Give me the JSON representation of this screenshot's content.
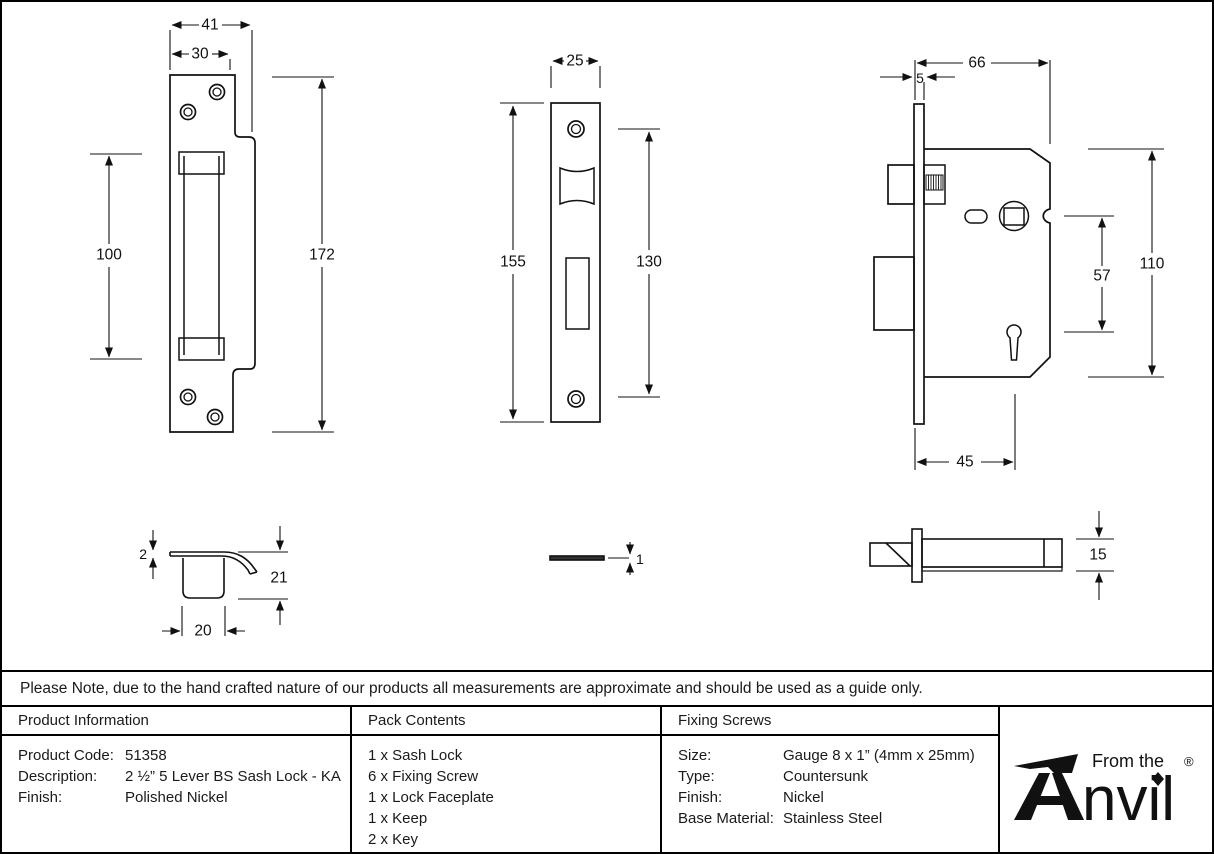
{
  "note": "Please Note, due to the hand crafted nature of our products all measurements are approximate and should be used as a guide only.",
  "drawings": {
    "keep_front": {
      "width": "41",
      "slot_width": "30",
      "pocket_height": "100",
      "height": "172"
    },
    "faceplate_front": {
      "width": "25",
      "height": "155",
      "screw_spacing": "130"
    },
    "lock_body": {
      "faceplate_thickness": "5",
      "depth": "66",
      "spindle_to_keyhole": "57",
      "height": "110",
      "backset": "45"
    },
    "keep_profile": {
      "plate_thickness": "2",
      "depth": "21",
      "width": "20"
    },
    "faceplate_profile": {
      "thickness": "1"
    },
    "lock_profile": {
      "thickness": "15"
    }
  },
  "table": {
    "product_information": {
      "header": "Product Information",
      "rows": [
        {
          "label": "Product Code:",
          "value": "51358"
        },
        {
          "label": "Description:",
          "value": "2 ½” 5 Lever BS Sash Lock - KA"
        },
        {
          "label": "Finish:",
          "value": "Polished Nickel"
        }
      ]
    },
    "pack_contents": {
      "header": "Pack Contents",
      "items": [
        "1 x Sash Lock",
        "6 x Fixing Screw",
        "1 x Lock Faceplate",
        "1 x Keep",
        "2 x Key"
      ]
    },
    "fixing_screws": {
      "header": "Fixing Screws",
      "rows": [
        {
          "label": "Size:",
          "value": "Gauge 8 x 1” (4mm x 25mm)"
        },
        {
          "label": "Type:",
          "value": "Countersunk"
        },
        {
          "label": "Finish:",
          "value": "Nickel"
        },
        {
          "label": "Base Material:",
          "value": "Stainless Steel"
        }
      ]
    }
  },
  "logo": {
    "tagline": "From the",
    "wordmark": "Anvil",
    "wordmark_rest": "nvil",
    "registered_mark": "®"
  },
  "colors": {
    "ink": "#111111",
    "background": "#ffffff"
  }
}
